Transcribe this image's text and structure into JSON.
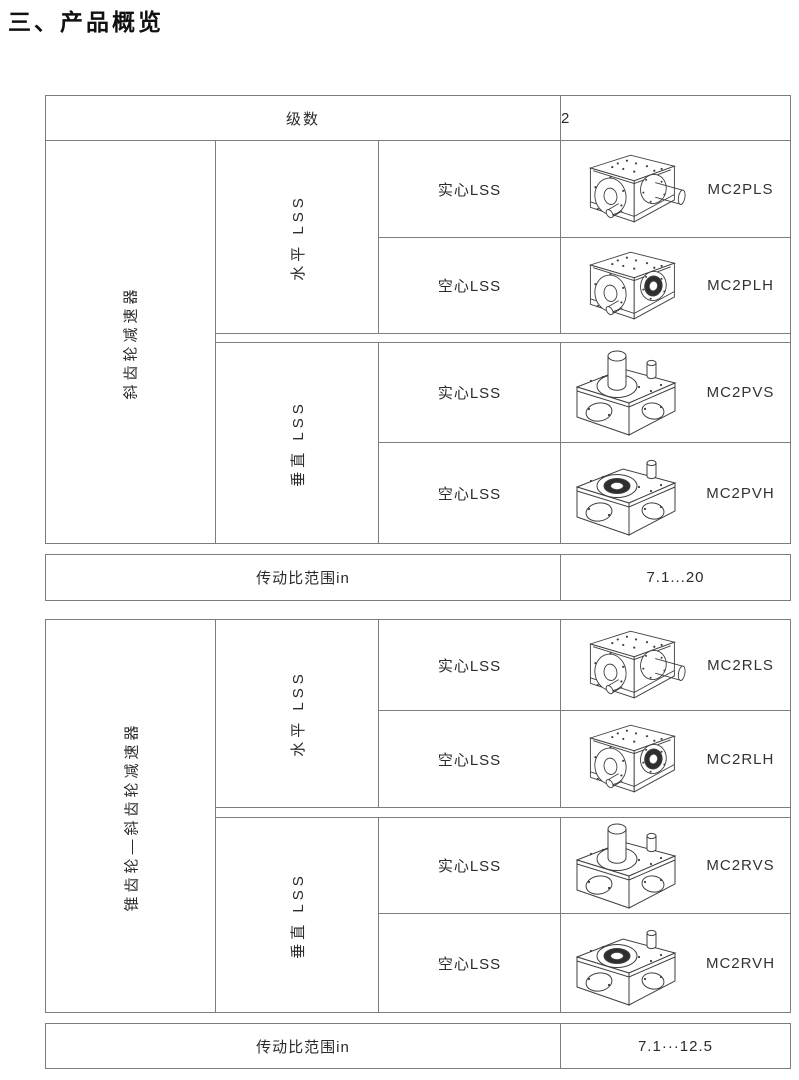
{
  "page": {
    "title": "三、产品概览"
  },
  "colors": {
    "table_border": "#7d7d7d",
    "text": "#2b2b2b",
    "bore_fill": "#2e2e2e"
  },
  "tables": [
    {
      "header": {
        "label": "级数",
        "value": "2"
      },
      "category": "斜齿轮减速器",
      "groups": [
        {
          "orientation": "水平 LSS",
          "rows": [
            {
              "shaft": "实心LSS",
              "model": "MC2PLS",
              "icon": "gearbox-horizontal-solid-lss"
            },
            {
              "shaft": "空心LSS",
              "model": "MC2PLH",
              "icon": "gearbox-horizontal-hollow-lss"
            }
          ]
        },
        {
          "orientation": "垂直 LSS",
          "rows": [
            {
              "shaft": "实心LSS",
              "model": "MC2PVS",
              "icon": "gearbox-vertical-solid-lss"
            },
            {
              "shaft": "空心LSS",
              "model": "MC2PVH",
              "icon": "gearbox-vertical-hollow-lss"
            }
          ]
        }
      ],
      "ratio": {
        "label": "传动比范围in",
        "value": "7.1...20"
      }
    },
    {
      "category": "锥齿轮—斜齿轮减速器",
      "groups": [
        {
          "orientation": "水平 LSS",
          "rows": [
            {
              "shaft": "实心LSS",
              "model": "MC2RLS",
              "icon": "gearbox-horizontal-solid-lss"
            },
            {
              "shaft": "空心LSS",
              "model": "MC2RLH",
              "icon": "gearbox-horizontal-hollow-lss"
            }
          ]
        },
        {
          "orientation": "垂直 LSS",
          "rows": [
            {
              "shaft": "实心LSS",
              "model": "MC2RVS",
              "icon": "gearbox-vertical-solid-lss"
            },
            {
              "shaft": "空心LSS",
              "model": "MC2RVH",
              "icon": "gearbox-vertical-hollow-lss"
            }
          ]
        }
      ],
      "ratio": {
        "label": "传动比范围in",
        "value": "7.1···12.5"
      }
    }
  ]
}
